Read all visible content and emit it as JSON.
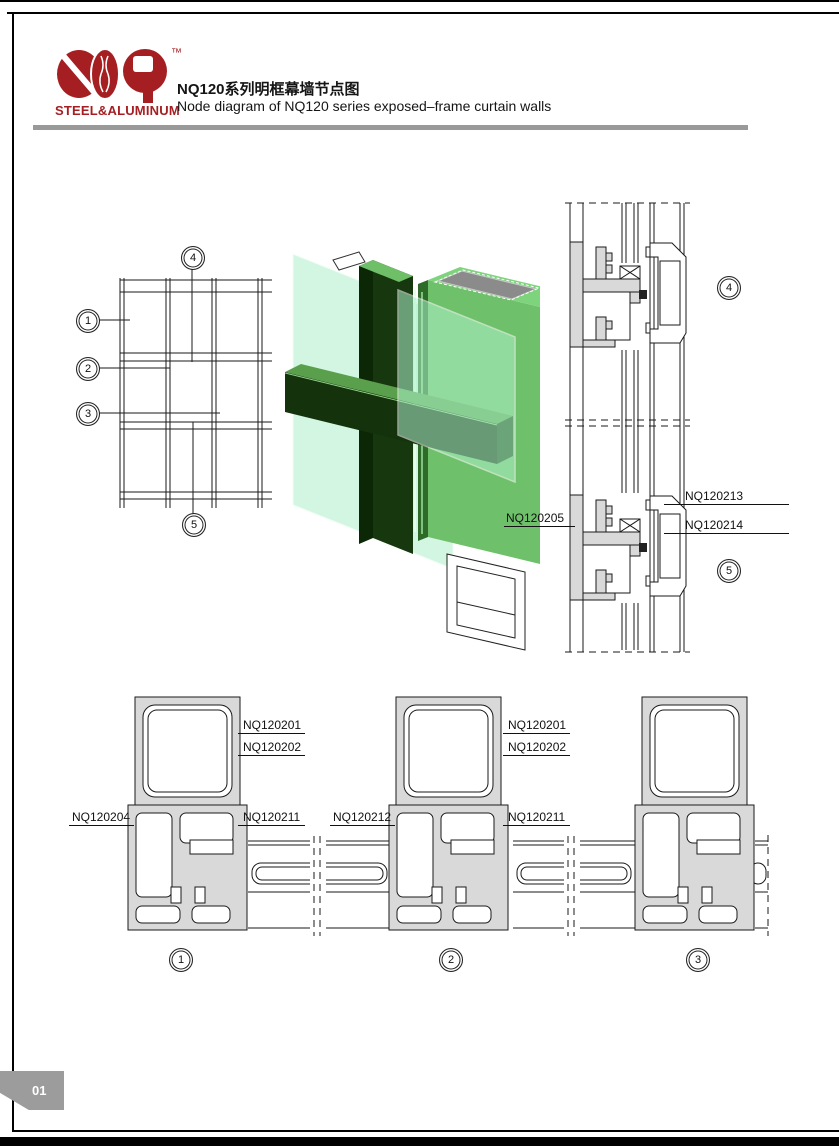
{
  "header": {
    "brand": "STEEL&ALUMINUM",
    "trademark": "™",
    "title_cn": "NQ120系列明框幕墙节点图",
    "title_en": "Node diagram of NQ120 series exposed–frame curtain walls"
  },
  "page": {
    "number": "01"
  },
  "plan": {
    "c1": "1",
    "c2": "2",
    "c3": "3",
    "c4": "4",
    "c5": "5"
  },
  "vertical_section": {
    "callout_top": "4",
    "callout_bottom": "5",
    "label_left": "NQ120205",
    "label_right_top": "NQ120213",
    "label_right_bottom": "NQ120214"
  },
  "details": {
    "d1": {
      "callout": "1",
      "top1": "NQ120201",
      "top2": "NQ120202",
      "left": "NQ120204",
      "right": "NQ120211"
    },
    "d2": {
      "callout": "2",
      "top1": "NQ120201",
      "top2": "NQ120202",
      "left": "NQ120212",
      "right": "NQ120211"
    },
    "d3": {
      "callout": "3"
    }
  },
  "colors": {
    "brand_red": "#a51e22",
    "divider_gray": "#999999",
    "tab_gray": "#9c9c9c",
    "profile_gray": "#d9d9d9",
    "glass_green": "#b6f1d0",
    "frame_green_dark": "#17380e",
    "frame_green": "#6fc06a",
    "cap_gray": "#8b8b8b"
  }
}
